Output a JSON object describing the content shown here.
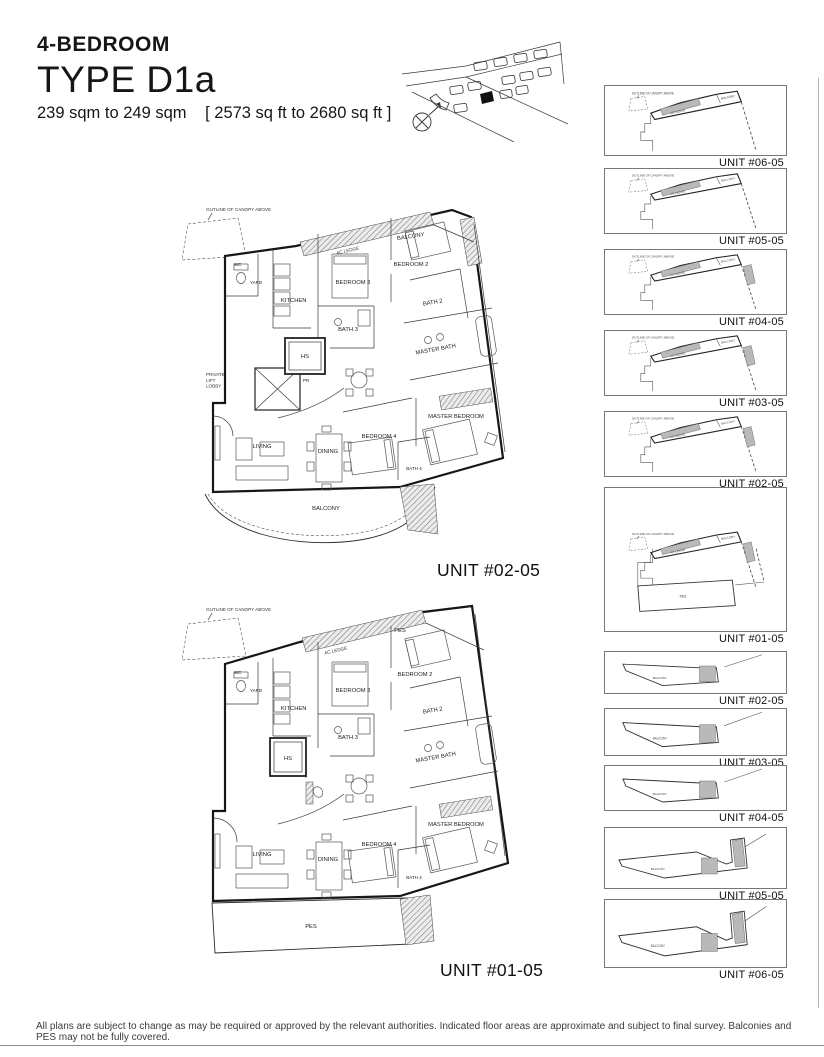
{
  "header": {
    "category": "4-BEDROOM",
    "type": "TYPE D1a",
    "area_metric": "239 sqm to 249 sqm",
    "area_imperial": "[ 2573 sq ft to 2680 sq ft ]"
  },
  "plans": [
    {
      "unit_label": "UNIT #02-05",
      "canopy_note": "OUTLINE OF CANOPY ABOVE",
      "rooms": {
        "balcony_top": "BALCONY",
        "ac_ledge": "AC LEDGE",
        "bedroom2": "BEDROOM 2",
        "bedroom3": "BEDROOM 3",
        "bath2": "BATH 2",
        "bath3": "BATH 3",
        "master_bath": "MASTER BATH",
        "wc": "WC",
        "yard": "YARD",
        "kitchen": "KITCHEN",
        "hs": "HS",
        "private_lift_lobby": "PRIVATE LIFT LOBBY",
        "pr": "PR",
        "living": "LIVING",
        "dining": "DINING",
        "bedroom4": "BEDROOM 4",
        "bath4": "BATH 4",
        "master_bedroom": "MASTER BEDROOM",
        "balcony_bottom": "BALCONY"
      }
    },
    {
      "unit_label": "UNIT #01-05",
      "canopy_note": "OUTLINE OF CANOPY ABOVE",
      "rooms": {
        "pes_top": "PES",
        "ac_ledge": "AC LEDGE",
        "bedroom2": "BEDROOM 2",
        "bedroom3": "BEDROOM 3",
        "bath2": "BATH 2",
        "bath3": "BATH 3",
        "master_bath": "MASTER BATH",
        "wc": "WC",
        "yard": "YARD",
        "kitchen": "KITCHEN",
        "hs": "HS",
        "living": "LIVING",
        "dining": "DINING",
        "bedroom4": "BEDROOM 4",
        "bath4": "BATH 4",
        "master_bedroom": "MASTER BEDROOM",
        "pes_bottom": "PES"
      }
    }
  ],
  "keyplan_parts": {
    "canopy_note": "OUTLINE OF CANOPY ABOVE",
    "ac_ledge": "AC LEDGE",
    "balcony": "BALCONY",
    "pes": "PES"
  },
  "keyplans": [
    {
      "label": "UNIT #06-05"
    },
    {
      "label": "UNIT #05-05"
    },
    {
      "label": "UNIT #04-05"
    },
    {
      "label": "UNIT #03-05"
    },
    {
      "label": "UNIT #02-05"
    },
    {
      "label": "UNIT #01-05"
    },
    {
      "label": "UNIT #02-05"
    },
    {
      "label": "UNIT #03-05"
    },
    {
      "label": "UNIT #04-05"
    },
    {
      "label": "UNIT #05-05"
    },
    {
      "label": "UNIT #06-05"
    }
  ],
  "footer": {
    "disclaimer": "All plans are subject to change as may be required or approved by the relevant authorities. Indicated floor areas are approximate and subject to final survey. Balconies and PES may not be fully covered."
  }
}
